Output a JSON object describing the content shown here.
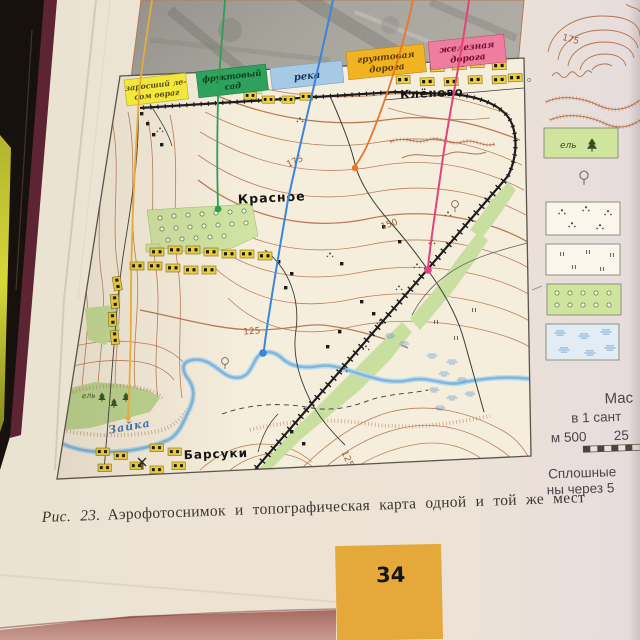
{
  "figure_labels": {
    "ravine": {
      "line1": "заросший ле-",
      "line2": "сом овраг"
    },
    "orchard": {
      "line1": "фруктовый",
      "line2": "сад"
    },
    "river": {
      "line1": "река"
    },
    "dirt_road": {
      "line1": "грунтовая",
      "line2": "дорога"
    },
    "railway": {
      "line1": "железная",
      "line2": "дорога"
    }
  },
  "map": {
    "villages": {
      "klenovo": "Клёново",
      "krasnoe": "Красное",
      "barsuki": "Барсуки"
    },
    "river_name": "Зайка",
    "contours": {
      "c175": "175",
      "c150": "150",
      "c125a": "125",
      "c125b": "125"
    },
    "spruce": "ель"
  },
  "legend": {
    "contour_value": "175",
    "spruce": "ель",
    "scale_title_fragment": "Мас",
    "scale_line2_fragment": "в 1 сант",
    "scale_bar_left": "м 500",
    "scale_bar_right": "25",
    "note_line1_fragment": "Сплошные",
    "note_line2_fragment": "ны через 5"
  },
  "caption": {
    "prefix": "Рис. 23.",
    "text": "Аэрофотоснимок и топографическая карта одной и той же мест"
  },
  "page_number": "34",
  "colors": {
    "ribbon_ravine": "#f2e73a",
    "ribbon_orchard": "#2ea25c",
    "ribbon_river": "#a6c9e6",
    "ribbon_dirt_road": "#f2b322",
    "ribbon_railway": "#ef7d9f",
    "leader_ravine": "#e8aa3a",
    "leader_orchard": "#2e9e52",
    "leader_river": "#3a86d8",
    "leader_dirt_road": "#e87828",
    "leader_railway": "#e0447a",
    "contour_brown": "#b5734e",
    "river_blue": "#7fb7dd",
    "page_tab": "#e5a83b"
  }
}
